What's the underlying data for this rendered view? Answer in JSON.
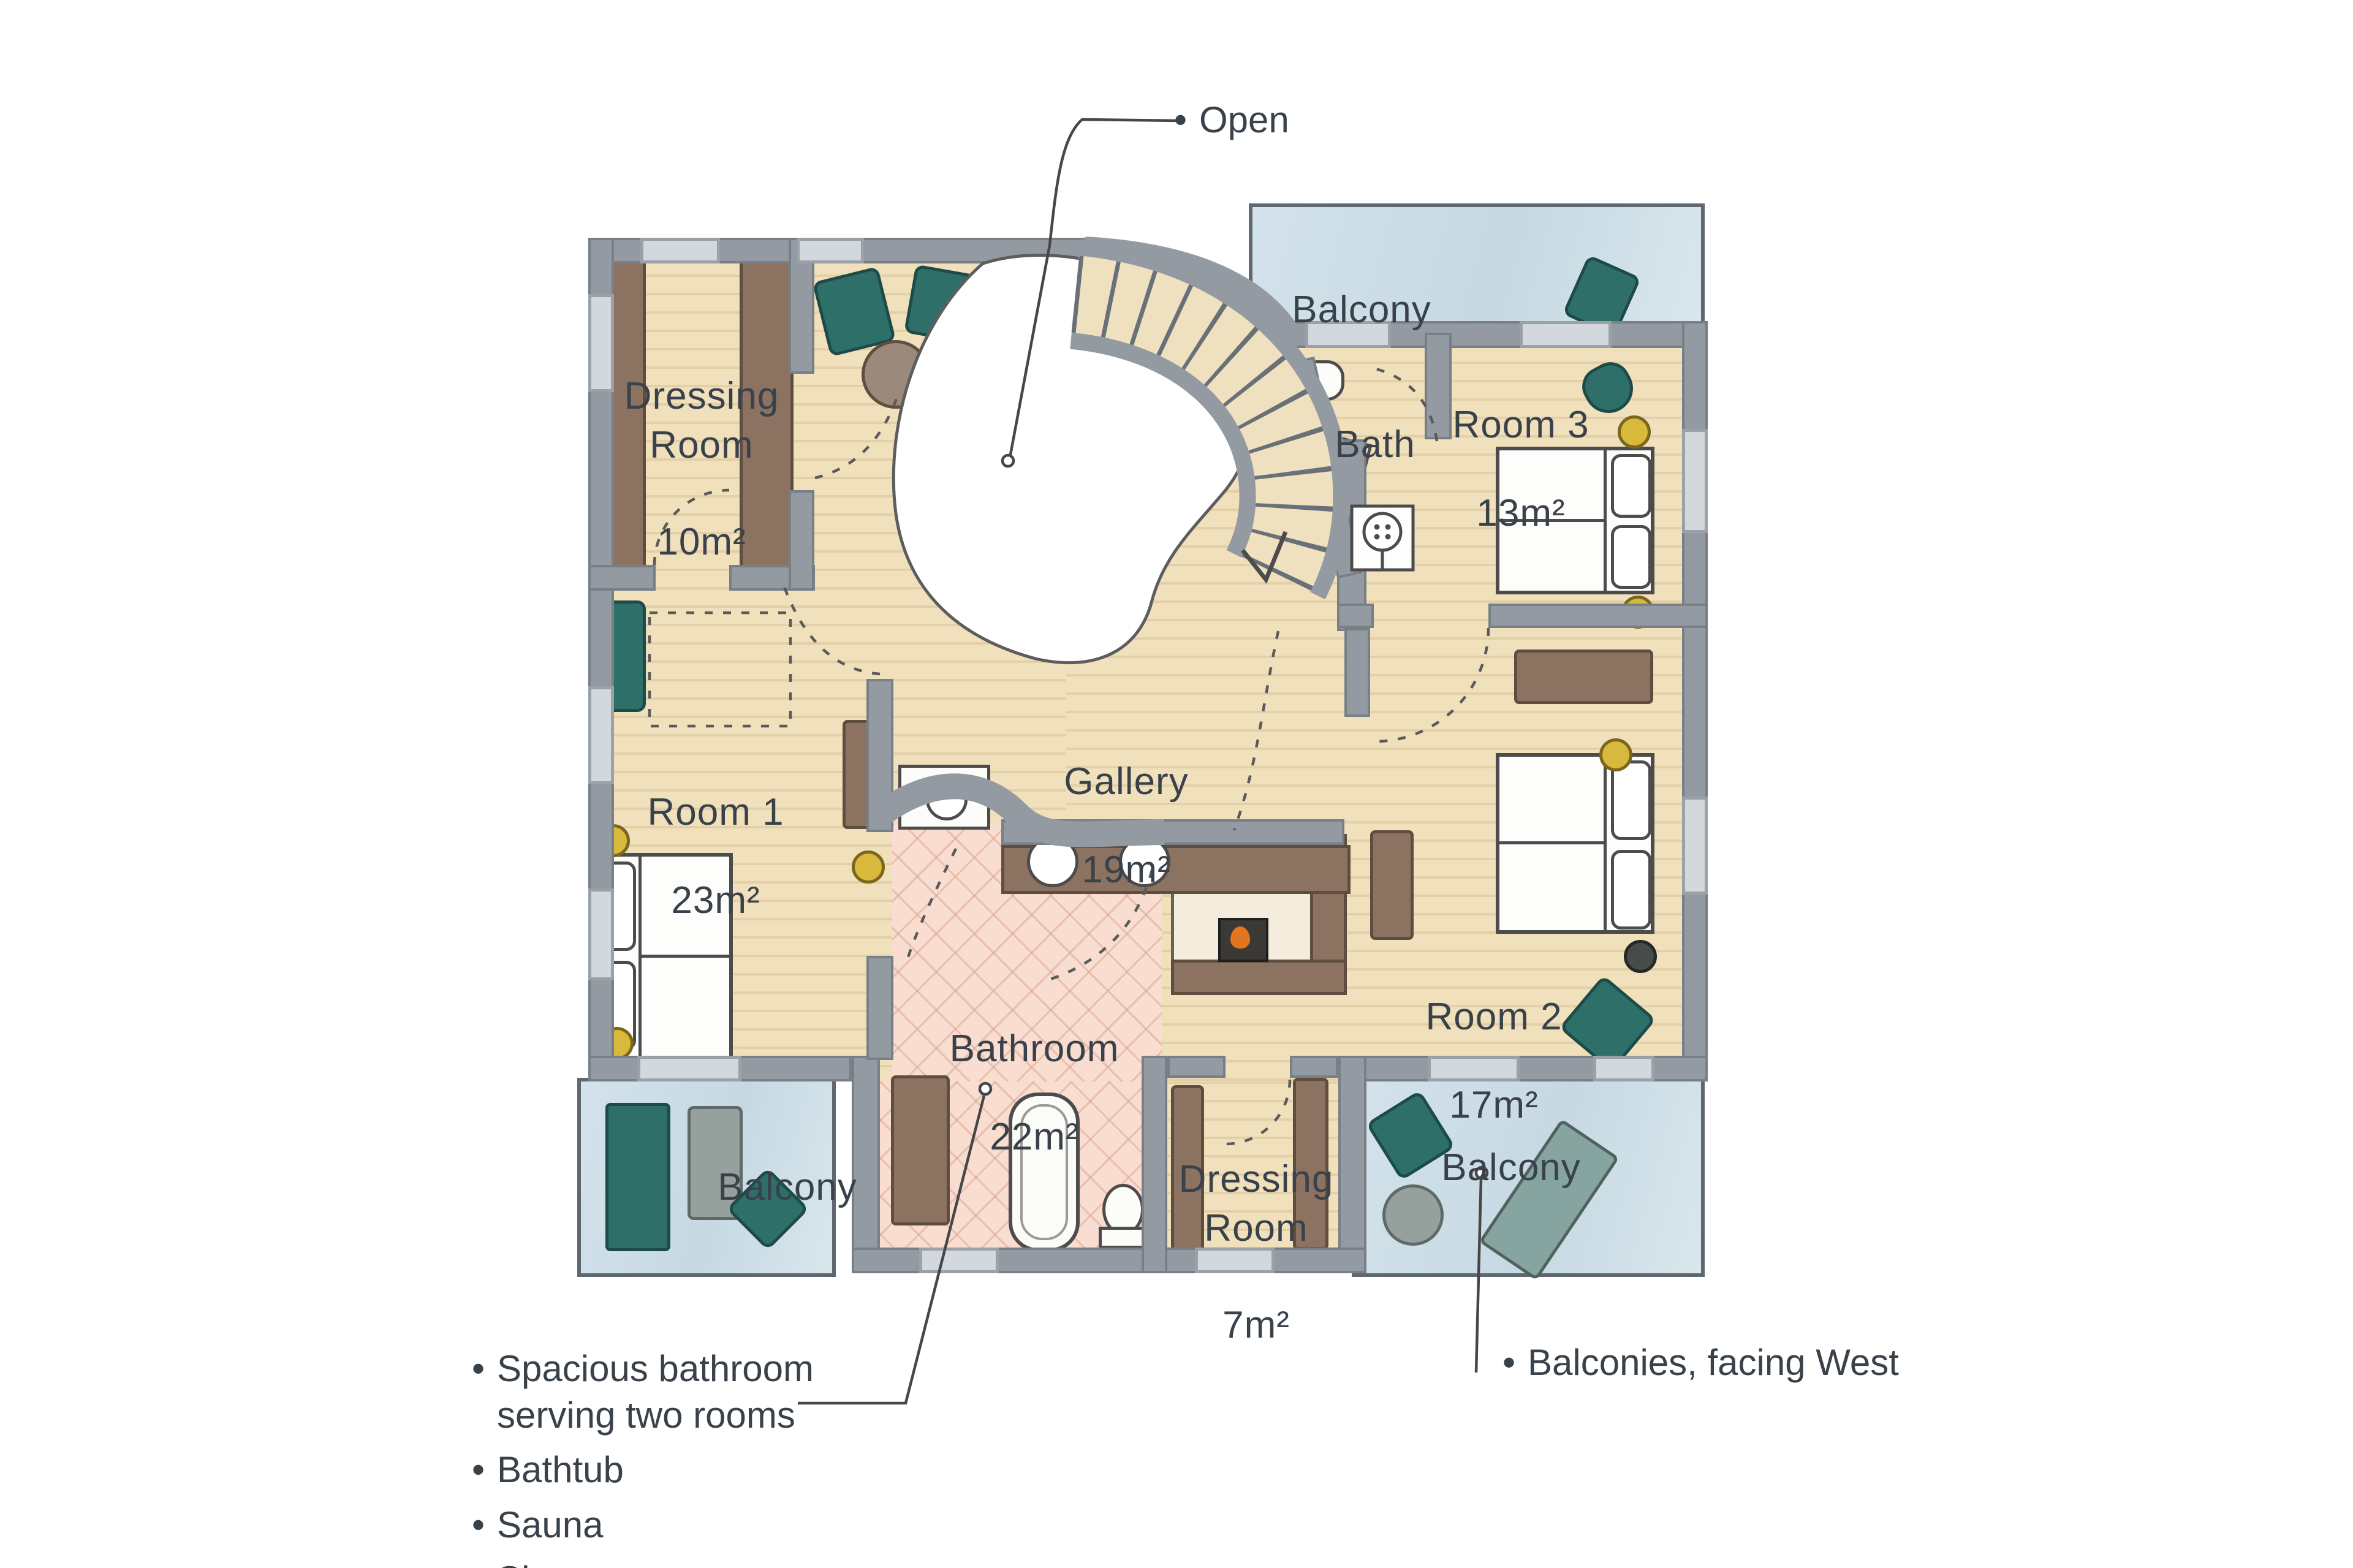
{
  "bullet": "•",
  "rooms": {
    "dressing_top": {
      "name": "Dressing\nRoom",
      "area": "10m²"
    },
    "room1": {
      "name": "Room 1",
      "area": "23m²"
    },
    "gallery": {
      "name": "Gallery",
      "area": "19m²"
    },
    "bath": {
      "name": "Bath"
    },
    "room3": {
      "name": "Room 3",
      "area": "13m²"
    },
    "room2": {
      "name": "Room 2",
      "area": "17m²"
    },
    "bathroom": {
      "name": "Bathroom",
      "area": "22m²"
    },
    "dressing_bottom": {
      "name": "Dressing\nRoom",
      "area": "7m²"
    },
    "balcony": {
      "label": "Balcony"
    }
  },
  "annotations": {
    "open": "Open",
    "notes": [
      "Spacious bathroom\nserving two rooms",
      "Bathtub",
      "Sauna",
      "Shower"
    ],
    "balconies_note": "Balconies, facing West"
  },
  "colors": {
    "wood_floor": "#f0e0bc",
    "wall_gray": "#949aa2",
    "balcony_blue": "#c8dbe4",
    "bathroom_pink": "#f8ddd0",
    "furniture_teal": "#2f6f6a",
    "furniture_brown": "#8b7261",
    "lamp_yellow": "#d9b93c",
    "stove_flame": "#e2761e",
    "text": "#39414a"
  }
}
